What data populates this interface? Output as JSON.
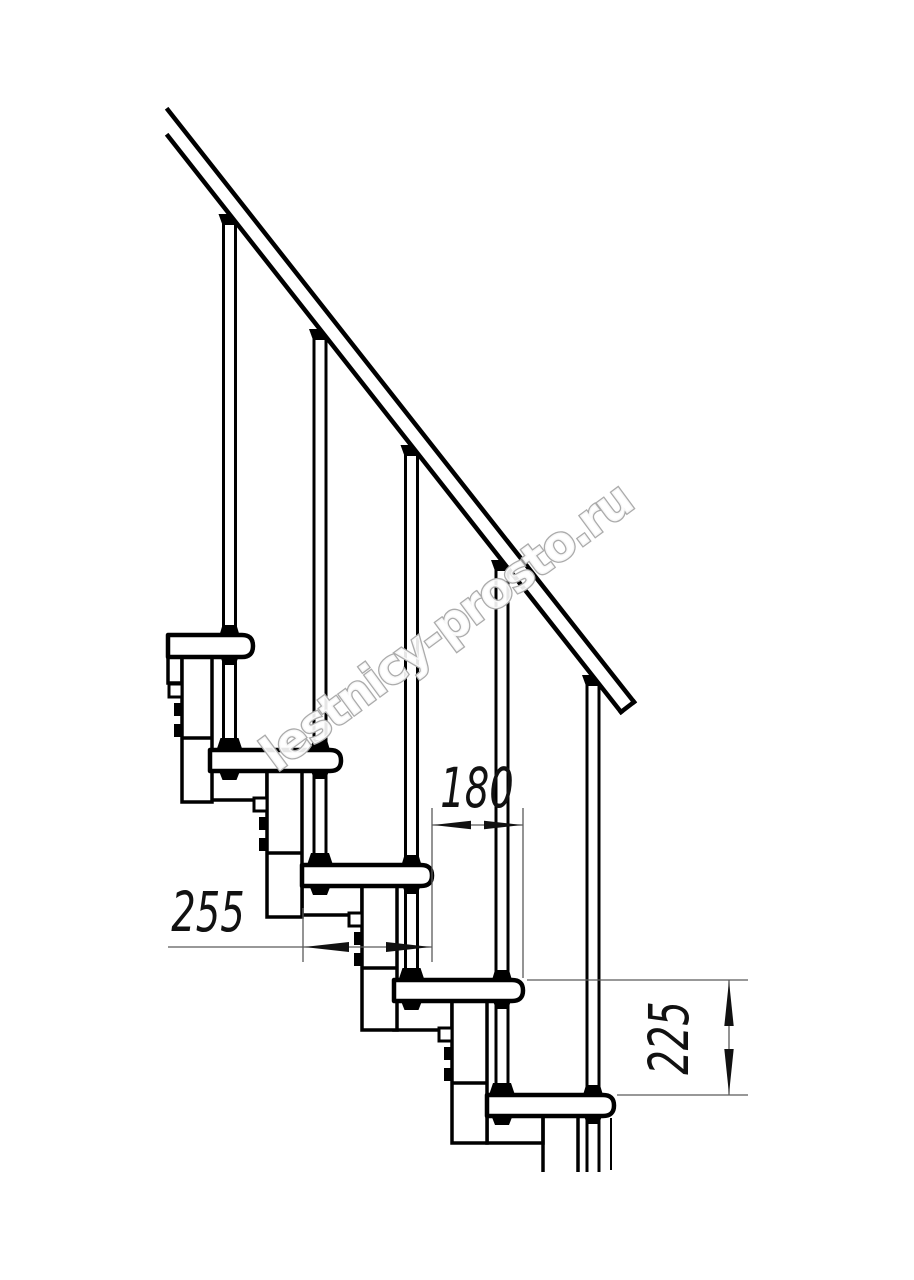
{
  "drawing": {
    "type": "technical-drawing",
    "subject": "modular staircase side view with handrail and baluster rods",
    "background": "#ffffff",
    "line_color": "#000000",
    "dim_line_color": "#5a5a5a",
    "dim_text_color": "#111111",
    "dimensions": {
      "tread_depth": "255",
      "step_run": "180",
      "riser_height": "225"
    },
    "watermark": {
      "text": "lestnicy-prosto.ru",
      "outline_color": "#ababab"
    }
  }
}
